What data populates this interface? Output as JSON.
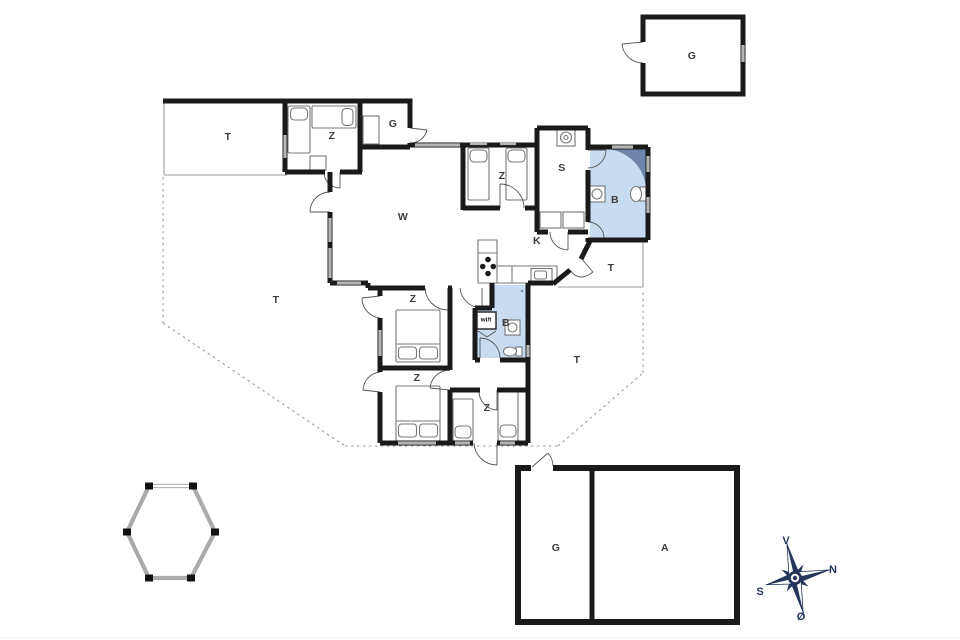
{
  "plan": {
    "labels": {
      "terrace_top": "T",
      "bedroom_topleft": "Z",
      "room_top": "G",
      "garage_detached": "G",
      "bedroom_mid_top": "Z",
      "utility": "S",
      "bathroom_main": "B",
      "living_room": "W",
      "kitchen": "K",
      "terrace_small": "T",
      "terrace_left": "T",
      "terrace_right": "T",
      "bedroom_center": "Z",
      "closet": "wi/t",
      "bathroom_second": "B",
      "bedroom_bottom_left": "Z",
      "bedroom_bottom_right": "Z",
      "garage_bottom": "G",
      "annex": "A"
    },
    "compass": {
      "west": "V",
      "north": "N",
      "south": "S",
      "east": "Ø"
    },
    "colors": {
      "wall": "#1a1a1a",
      "bathroom_fill": "#c7dbf1",
      "shower_fill": "#6f84a9",
      "window_gray": "#b4b4b4",
      "compass_navy": "#25355c",
      "terrace_dash": "#9b9b9b"
    }
  }
}
